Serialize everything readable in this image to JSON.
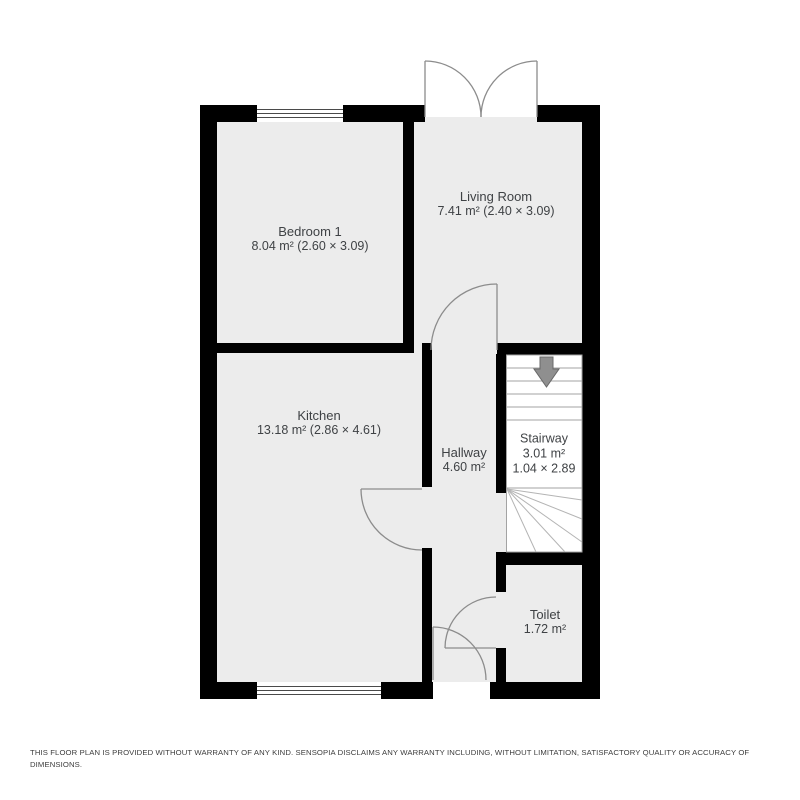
{
  "floor_plan": {
    "title": "ground-floor-plan",
    "rooms": {
      "bedroom1": {
        "name": "Bedroom 1",
        "details": "8.04 m² (2.60 × 3.09)"
      },
      "living_room": {
        "name": "Living Room",
        "details": "7.41 m² (2.40 × 3.09)"
      },
      "kitchen": {
        "name": "Kitchen",
        "details": "13.18 m² (2.86 × 4.61)"
      },
      "hallway": {
        "name": "Hallway",
        "details": "4.60 m²"
      },
      "stairway": {
        "name": "Stairway",
        "area": "3.01 m²",
        "dimensions": "1.04 × 2.89"
      },
      "toilet": {
        "name": "Toilet",
        "details": "1.72 m²"
      }
    },
    "features": {
      "windows": 2,
      "doors": [
        "double-entry-door-top",
        "living-room-door",
        "kitchen-door",
        "toilet-door",
        "front-door-bottom"
      ],
      "stair_direction_icon": "down-arrow"
    },
    "colors": {
      "wall": "#000000",
      "floor": "#ececec",
      "stair_floor": "#ffffff",
      "door_arc": "#8c8c8c",
      "stair_lines": "#a3a3a3",
      "arrow_fill": "#8f8f8f",
      "label_text": "#3f4245",
      "background": "#ffffff"
    }
  },
  "disclaimer": "THIS FLOOR PLAN IS PROVIDED WITHOUT WARRANTY OF ANY KIND. SENSOPIA DISCLAIMS ANY WARRANTY INCLUDING, WITHOUT LIMITATION, SATISFACTORY QUALITY OR ACCURACY OF DIMENSIONS."
}
